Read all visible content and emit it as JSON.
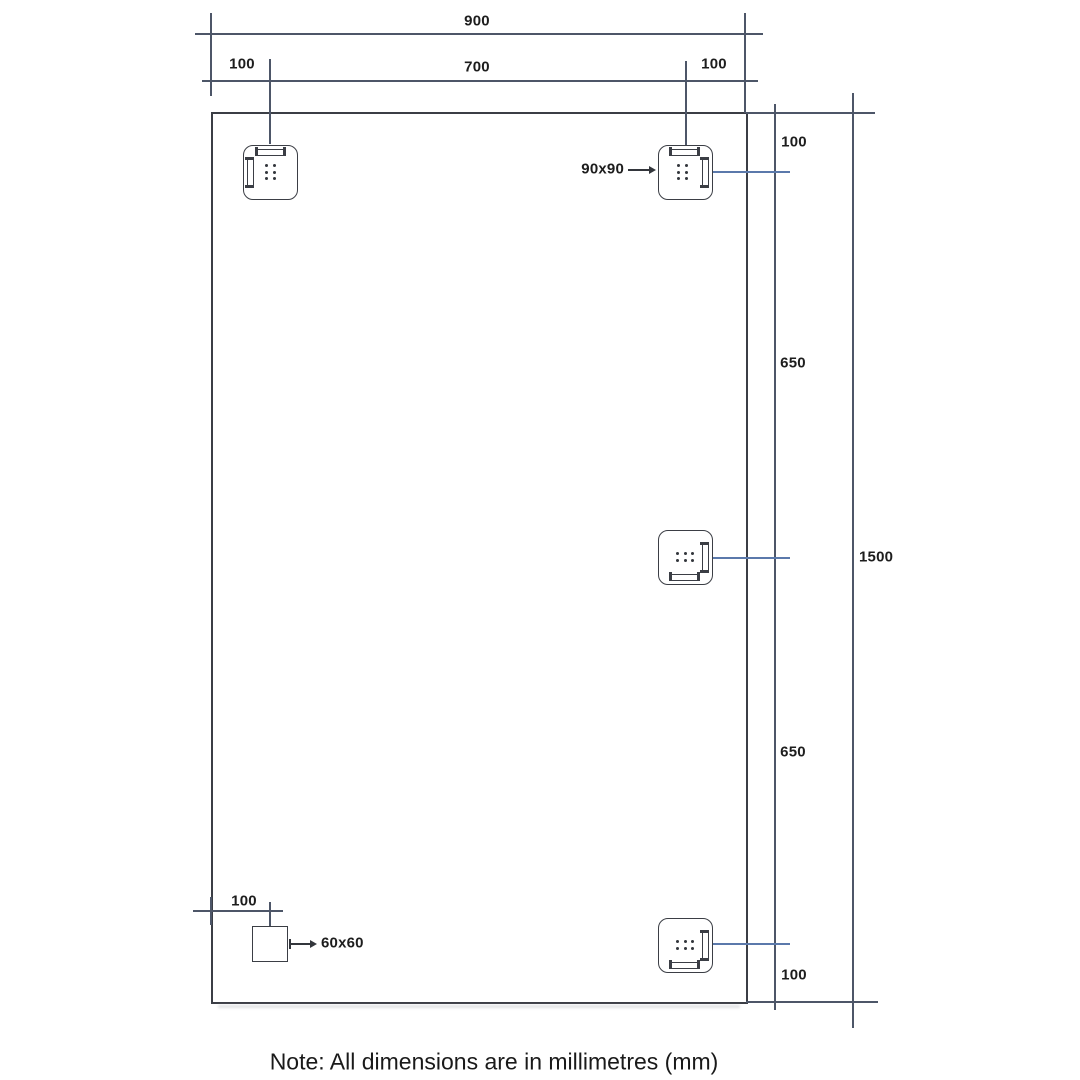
{
  "drawing": {
    "title": "Mirror mounting dimensional drawing",
    "note": "Note: All dimensions are in millimetres (mm)",
    "units": "mm",
    "dimensions": {
      "overall_width": "900",
      "top_offset_left": "100",
      "top_center_span": "700",
      "top_offset_right": "100",
      "right_offset_top": "100",
      "right_span_upper": "650",
      "overall_height": "1500",
      "right_span_lower": "650",
      "right_offset_bottom": "100",
      "bottom_offset_left": "100",
      "bracket_size_label": "90x90",
      "block_size_label": "60x60"
    },
    "colors": {
      "object_line": "#3b3e45",
      "extension_line": "#4d5668",
      "dimension_line_blue": "#5b79ab",
      "text": "#1d1d1d",
      "background": "#ffffff"
    }
  }
}
